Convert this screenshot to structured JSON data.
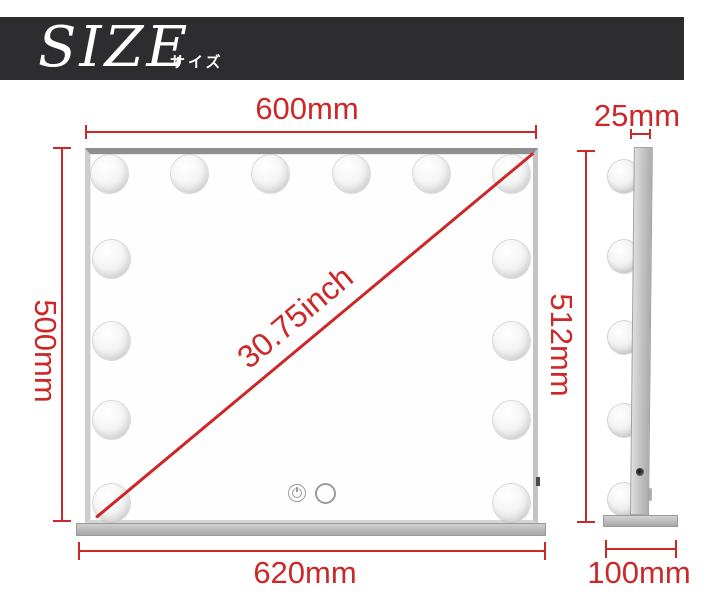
{
  "banner": {
    "title": "SIZE",
    "subtitle": "サイズ"
  },
  "front_view": {
    "top_width_label": "600mm",
    "left_height_label": "500mm",
    "diagonal_label": "30.75inch",
    "base_width_label": "620mm",
    "bulb_count": 14,
    "touch_controls": [
      "power-icon",
      "ring-icon"
    ]
  },
  "side_view": {
    "thickness_label": "25mm",
    "height_label": "512mm",
    "base_depth_label": "100mm",
    "bulb_count": 5
  },
  "colors": {
    "dimension_red": "#cc2828",
    "banner_background": "#2d2d2f",
    "banner_text": "#ffffff",
    "frame_gray": "#c6c6c6",
    "base_gray": "#b5b5b5"
  }
}
